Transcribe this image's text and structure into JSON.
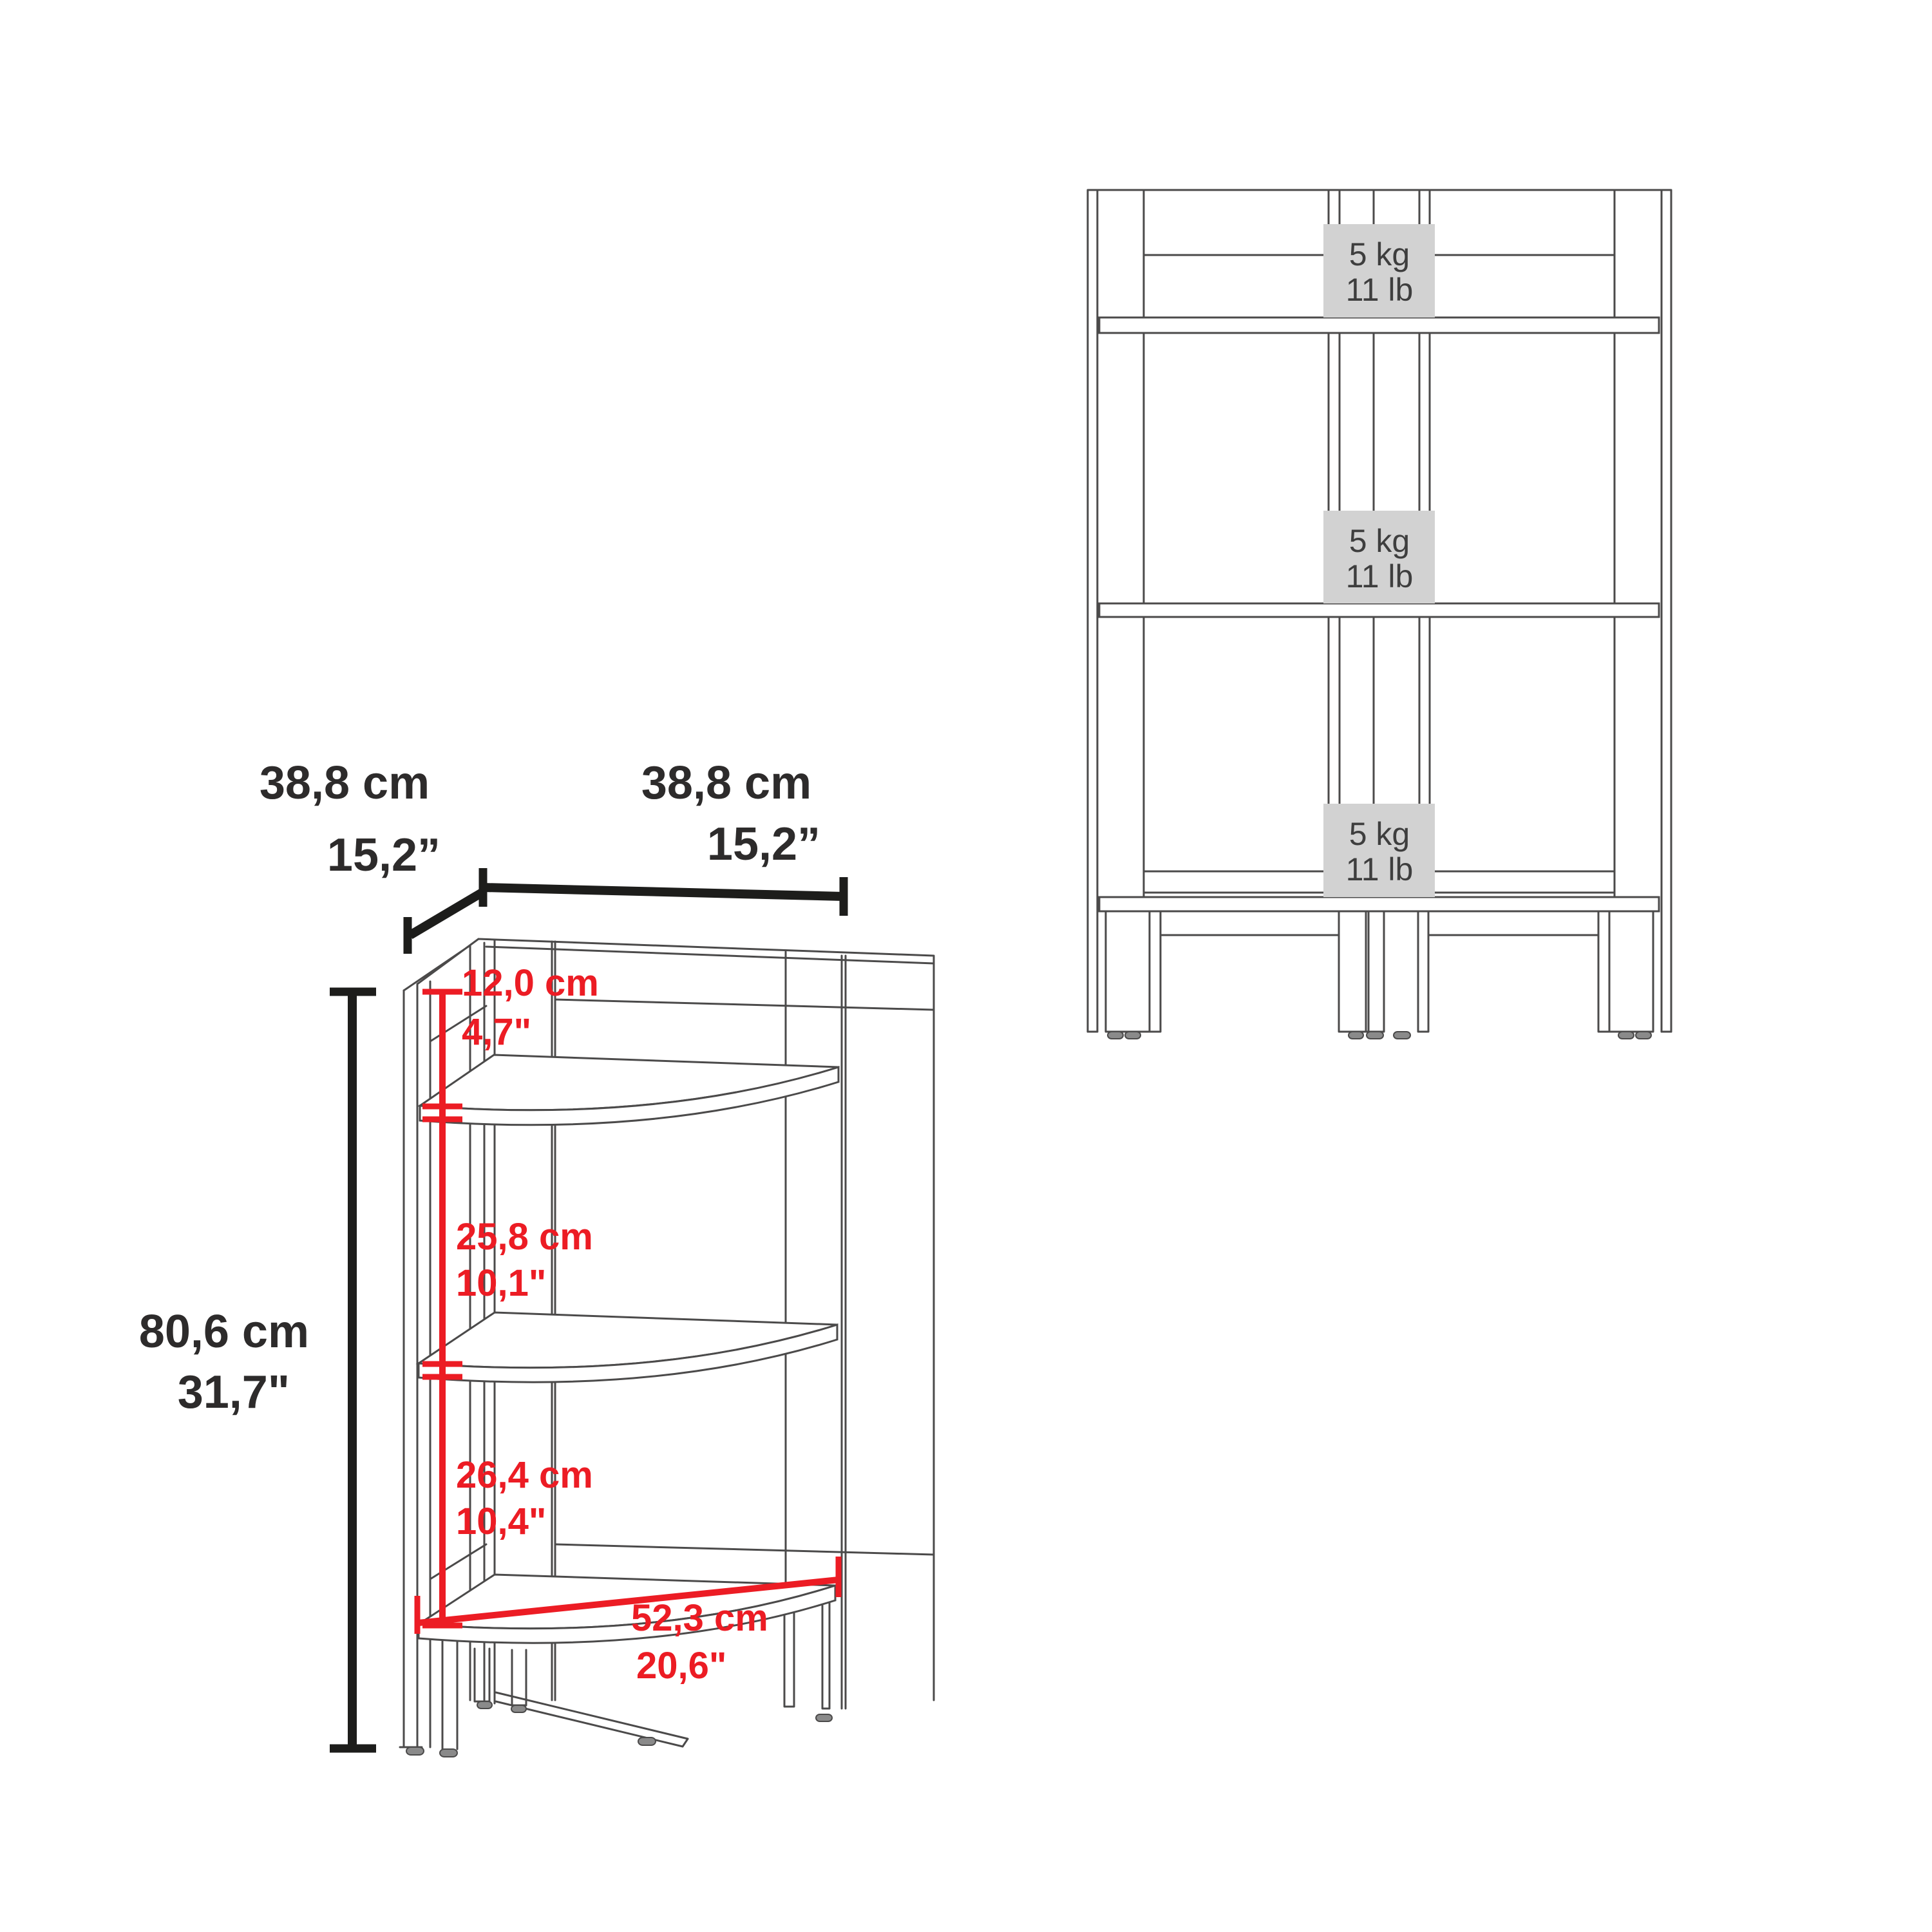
{
  "colors": {
    "accent_red": "#ec1c24",
    "drawing_line": "#4b4a4a",
    "dimension_line": "#1d1d1b",
    "capacity_box_fill": "#d2d2d2",
    "capacity_box_text": "#3e3e3e"
  },
  "perspective_view": {
    "depth": {
      "cm": "38,8 cm",
      "inch": "15,2”"
    },
    "width": {
      "cm": "38,8 cm",
      "inch": "15,2”"
    },
    "height": {
      "cm": "80,6 cm",
      "inch": "31,7\""
    },
    "top_gap": {
      "cm": "12,0 cm",
      "inch": "4,7\""
    },
    "middle_gap": {
      "cm": "25,8 cm",
      "inch": "10,1\""
    },
    "bottom_gap": {
      "cm": "26,4 cm",
      "inch": "10,4\""
    },
    "shelf_diagonal": {
      "cm": "52,3 cm",
      "inch": "20,6\""
    }
  },
  "front_view": {
    "shelves": [
      {
        "kg": "5 kg",
        "lb": "11 lb"
      },
      {
        "kg": "5 kg",
        "lb": "11 lb"
      },
      {
        "kg": "5 kg",
        "lb": "11 lb"
      }
    ]
  }
}
